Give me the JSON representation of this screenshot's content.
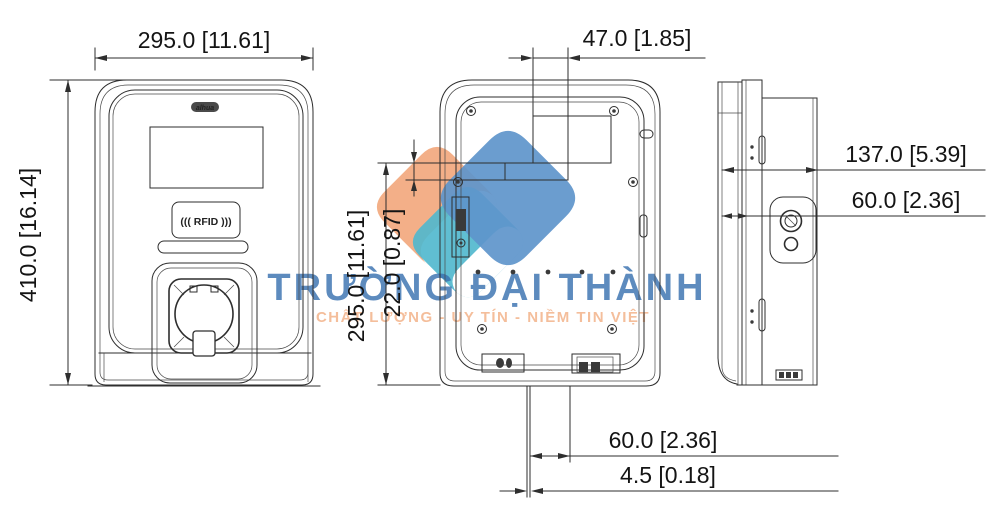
{
  "front_view": {
    "width_dim": "295.0 [11.61]",
    "height_dim": "410.0 [16.14]",
    "brand_label": "alhua",
    "rfid_label": "((( RFID )))"
  },
  "rear_view": {
    "mount_offset_dim": "47.0 [1.85]",
    "height_dim": "295.0 [11.61]",
    "side_offset_dim": "22.0 [0.87]",
    "bottom_offset_dim": "60.0 [2.36]",
    "base_thickness_dim": "4.5 [0.18]"
  },
  "side_view": {
    "depth_dim": "137.0 [5.39]",
    "mount_depth_dim": "60.0 [2.36]"
  },
  "watermark": {
    "company": "TRƯỜNG ĐẠI THÀNH",
    "tagline": "CHẤT LƯỢNG - UY TÍN - NIỀM TIN VIỆT",
    "colors": {
      "orange": "#F2A97E",
      "teal": "#4FB8CE",
      "blue": "#5E95CB",
      "text_blue": "#3A72B0",
      "text_orange": "#F2AC80"
    }
  }
}
